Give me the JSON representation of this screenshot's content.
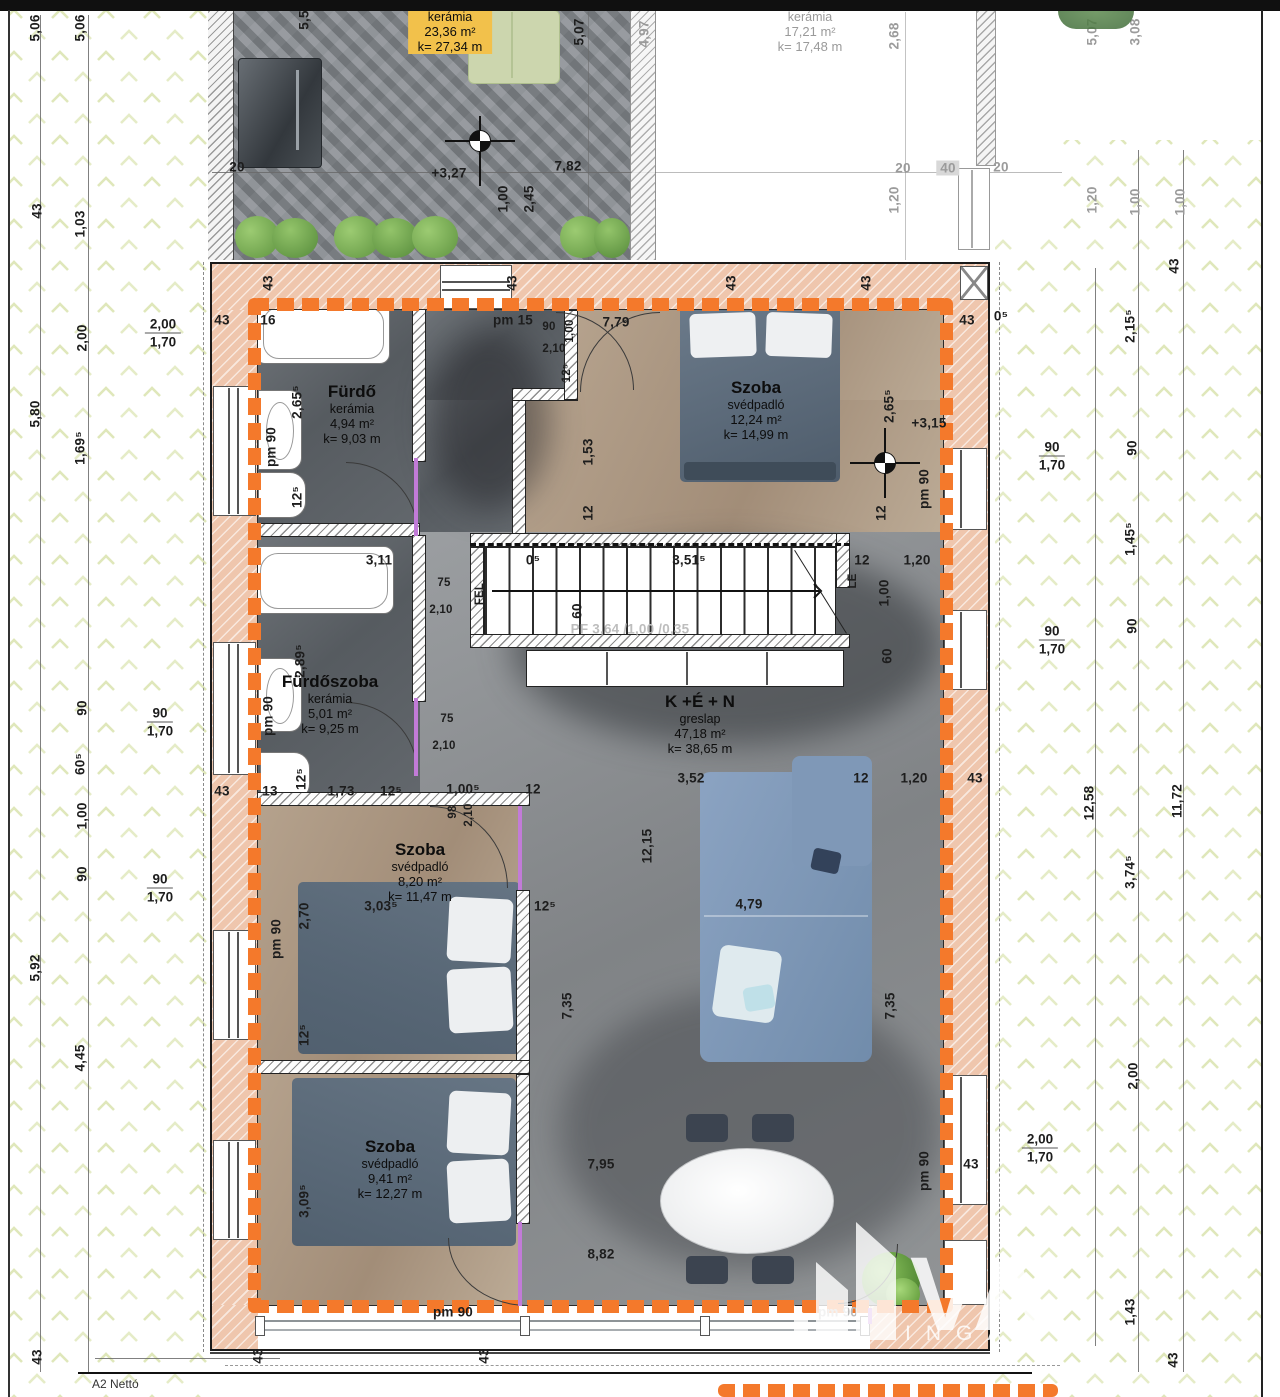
{
  "sheet": {
    "bottom_label": "A2   Nettó"
  },
  "colors": {
    "accent_orange": "#f4792b",
    "wall_pink": "#efc6ad",
    "highlight_yellow": "#f2c14b",
    "sofa_blue": "#7f99bb"
  },
  "watermark": {
    "letters": "VA",
    "sub": "INGA"
  },
  "stair": {
    "spec": "PF 3,64 /1,00 /0,35",
    "up": "FEL",
    "down": "LE"
  },
  "rooms": [
    {
      "title": "Tetőterasz",
      "mat": "kerámia",
      "area": "23,36 m²",
      "k": "k= 27,34 m",
      "x": 450,
      "y": -10,
      "cls": "hl"
    },
    {
      "title": "Tetőterasz",
      "mat": "kerámia",
      "area": "17,21 m²",
      "k": "k= 17,48 m",
      "x": 810,
      "y": -10,
      "cls": "grey"
    },
    {
      "title": "Fürdő",
      "mat": "kerámia",
      "area": "4,94 m²",
      "k": "k= 9,03 m",
      "x": 352,
      "y": 382,
      "cls": ""
    },
    {
      "title": "Szoba",
      "mat": "svédpadló",
      "area": "12,24 m²",
      "k": "k= 14,99 m",
      "x": 756,
      "y": 378,
      "cls": ""
    },
    {
      "title": "Fürdőszoba",
      "mat": "kerámia",
      "area": "5,01 m²",
      "k": "k= 9,25 m",
      "x": 330,
      "y": 672,
      "cls": ""
    },
    {
      "title": "K +É + N",
      "mat": "greslap",
      "area": "47,18 m²",
      "k": "k= 38,65 m",
      "x": 700,
      "y": 692,
      "cls": ""
    },
    {
      "title": "Szoba",
      "mat": "svédpadló",
      "area": "8,20 m²",
      "k": "k= 11,47 m",
      "x": 420,
      "y": 840,
      "cls": ""
    },
    {
      "title": "Szoba",
      "mat": "svédpadló",
      "area": "9,41 m²",
      "k": "k= 12,27 m",
      "x": 390,
      "y": 1137,
      "cls": ""
    }
  ],
  "window_tags": [
    {
      "top": "2,00",
      "bot": "1,70",
      "x": 163,
      "y": 333
    },
    {
      "top": "90",
      "bot": "1,70",
      "x": 160,
      "y": 722
    },
    {
      "top": "90",
      "bot": "1,70",
      "x": 160,
      "y": 888
    },
    {
      "top": "90",
      "bot": "1,70",
      "x": 1052,
      "y": 456
    },
    {
      "top": "90",
      "bot": "1,70",
      "x": 1052,
      "y": 640
    },
    {
      "top": "2,00",
      "bot": "1,70",
      "x": 1040,
      "y": 1148
    }
  ],
  "dimensions": [
    {
      "t": "5,06",
      "x": 35,
      "y": 28,
      "v": 1
    },
    {
      "t": "5,06",
      "x": 80,
      "y": 28,
      "v": 1
    },
    {
      "t": "5,5",
      "x": 304,
      "y": 20,
      "v": 1
    },
    {
      "t": "5,07",
      "x": 579,
      "y": 32,
      "v": 1
    },
    {
      "t": "4,97",
      "x": 644,
      "y": 34,
      "v": 1,
      "c": "g"
    },
    {
      "t": "2,68",
      "x": 894,
      "y": 36,
      "v": 1,
      "c": "g"
    },
    {
      "t": "5,07",
      "x": 1092,
      "y": 32,
      "v": 1,
      "c": "g"
    },
    {
      "t": "3,08",
      "x": 1135,
      "y": 32,
      "v": 1,
      "c": "g"
    },
    {
      "t": "20",
      "x": 237,
      "y": 167
    },
    {
      "t": "+3,27",
      "x": 449,
      "y": 173
    },
    {
      "t": "7,82",
      "x": 568,
      "y": 166
    },
    {
      "t": "1,00",
      "x": 503,
      "y": 199,
      "v": 1
    },
    {
      "t": "2,45",
      "x": 529,
      "y": 199,
      "v": 1
    },
    {
      "t": "20",
      "x": 903,
      "y": 168,
      "c": "g"
    },
    {
      "t": "40",
      "x": 948,
      "y": 168,
      "c": "g",
      "b": 1
    },
    {
      "t": "20",
      "x": 1001,
      "y": 167,
      "c": "g"
    },
    {
      "t": "1,20",
      "x": 894,
      "y": 200,
      "v": 1,
      "c": "g"
    },
    {
      "t": "1,20",
      "x": 1092,
      "y": 200,
      "v": 1,
      "c": "g"
    },
    {
      "t": "1,00",
      "x": 1135,
      "y": 202,
      "v": 1,
      "c": "g"
    },
    {
      "t": "1,00",
      "x": 1180,
      "y": 202,
      "v": 1,
      "c": "g"
    },
    {
      "t": "43",
      "x": 37,
      "y": 211,
      "v": 1
    },
    {
      "t": "1,03",
      "x": 80,
      "y": 224,
      "v": 1
    },
    {
      "t": "2,00",
      "x": 82,
      "y": 338,
      "v": 1
    },
    {
      "t": "5,80",
      "x": 35,
      "y": 414,
      "v": 1
    },
    {
      "t": "1,69⁵",
      "x": 80,
      "y": 448,
      "v": 1
    },
    {
      "t": "90",
      "x": 82,
      "y": 708,
      "v": 1
    },
    {
      "t": "60⁵",
      "x": 80,
      "y": 764,
      "v": 1
    },
    {
      "t": "1,00",
      "x": 82,
      "y": 816,
      "v": 1
    },
    {
      "t": "90",
      "x": 82,
      "y": 874,
      "v": 1
    },
    {
      "t": "5,92",
      "x": 35,
      "y": 968,
      "v": 1
    },
    {
      "t": "4,45",
      "x": 80,
      "y": 1058,
      "v": 1
    },
    {
      "t": "43",
      "x": 37,
      "y": 1357,
      "v": 1
    },
    {
      "t": "43",
      "x": 222,
      "y": 320
    },
    {
      "t": "16",
      "x": 268,
      "y": 320
    },
    {
      "t": "43",
      "x": 268,
      "y": 283,
      "v": 1
    },
    {
      "t": "43",
      "x": 512,
      "y": 283,
      "v": 1
    },
    {
      "t": "43",
      "x": 731,
      "y": 283,
      "v": 1
    },
    {
      "t": "43",
      "x": 866,
      "y": 283,
      "v": 1
    },
    {
      "t": "pm 15",
      "x": 513,
      "y": 320
    },
    {
      "t": "90",
      "x": 549,
      "y": 327,
      "c": "sm"
    },
    {
      "t": "2,10",
      "x": 554,
      "y": 349,
      "c": "sm"
    },
    {
      "t": "1,00",
      "x": 570,
      "y": 331,
      "v": 1,
      "c": "sm"
    },
    {
      "t": "12⁵",
      "x": 567,
      "y": 373,
      "v": 1,
      "c": "sm"
    },
    {
      "t": "7,79",
      "x": 616,
      "y": 322
    },
    {
      "t": "43",
      "x": 967,
      "y": 320
    },
    {
      "t": "0⁵",
      "x": 1001,
      "y": 316
    },
    {
      "t": "2,65⁵",
      "x": 297,
      "y": 402,
      "v": 1
    },
    {
      "t": "pm 90",
      "x": 271,
      "y": 447,
      "v": 1
    },
    {
      "t": "12⁵",
      "x": 297,
      "y": 497,
      "v": 1
    },
    {
      "t": "1,53",
      "x": 588,
      "y": 452,
      "v": 1
    },
    {
      "t": "12",
      "x": 588,
      "y": 513,
      "v": 1
    },
    {
      "t": "2,65⁵",
      "x": 889,
      "y": 406,
      "v": 1
    },
    {
      "t": "+3,15",
      "x": 929,
      "y": 423
    },
    {
      "t": "pm 90",
      "x": 924,
      "y": 489,
      "v": 1
    },
    {
      "t": "12",
      "x": 881,
      "y": 513,
      "v": 1
    },
    {
      "t": "2,15⁵",
      "x": 1130,
      "y": 326,
      "v": 1
    },
    {
      "t": "43",
      "x": 1174,
      "y": 266,
      "v": 1
    },
    {
      "t": "90",
      "x": 1132,
      "y": 448,
      "v": 1
    },
    {
      "t": "1,45⁵",
      "x": 1130,
      "y": 539,
      "v": 1
    },
    {
      "t": "90",
      "x": 1132,
      "y": 626,
      "v": 1
    },
    {
      "t": "3,11",
      "x": 379,
      "y": 560
    },
    {
      "t": "0⁵",
      "x": 533,
      "y": 560
    },
    {
      "t": "3,51⁵",
      "x": 689,
      "y": 560
    },
    {
      "t": "12",
      "x": 862,
      "y": 560
    },
    {
      "t": "1,20",
      "x": 917,
      "y": 560
    },
    {
      "t": "1,00",
      "x": 884,
      "y": 593,
      "v": 1
    },
    {
      "t": "60",
      "x": 577,
      "y": 611,
      "v": 1
    },
    {
      "t": "60",
      "x": 887,
      "y": 656,
      "v": 1
    },
    {
      "t": "FEL",
      "x": 480,
      "y": 594,
      "v": 1,
      "c": "sm"
    },
    {
      "t": "LE",
      "x": 853,
      "y": 581,
      "v": 1,
      "c": "sm"
    },
    {
      "t": "PF 3,64 /1,00 /0,35",
      "x": 630,
      "y": 629,
      "c": "lg"
    },
    {
      "t": "2,89⁵",
      "x": 300,
      "y": 661,
      "v": 1
    },
    {
      "t": "pm 90",
      "x": 268,
      "y": 716,
      "v": 1
    },
    {
      "t": "75",
      "x": 444,
      "y": 583,
      "c": "sm"
    },
    {
      "t": "2,10",
      "x": 441,
      "y": 610,
      "c": "sm"
    },
    {
      "t": "75",
      "x": 447,
      "y": 719,
      "c": "sm"
    },
    {
      "t": "2,10",
      "x": 444,
      "y": 746,
      "c": "sm"
    },
    {
      "t": "12⁵",
      "x": 301,
      "y": 779,
      "v": 1
    },
    {
      "t": "43",
      "x": 222,
      "y": 791
    },
    {
      "t": "13",
      "x": 270,
      "y": 791
    },
    {
      "t": "1,73",
      "x": 341,
      "y": 791
    },
    {
      "t": "12⁵",
      "x": 391,
      "y": 791
    },
    {
      "t": "1,00⁵",
      "x": 463,
      "y": 789
    },
    {
      "t": "98",
      "x": 453,
      "y": 812,
      "v": 1,
      "c": "sm"
    },
    {
      "t": "2,10",
      "x": 469,
      "y": 815,
      "v": 1,
      "c": "sm"
    },
    {
      "t": "12",
      "x": 533,
      "y": 789
    },
    {
      "t": "3,52",
      "x": 691,
      "y": 778
    },
    {
      "t": "12",
      "x": 861,
      "y": 778
    },
    {
      "t": "1,20",
      "x": 914,
      "y": 778
    },
    {
      "t": "43",
      "x": 975,
      "y": 778
    },
    {
      "t": "12,15",
      "x": 647,
      "y": 846,
      "v": 1
    },
    {
      "t": "3,03⁵",
      "x": 381,
      "y": 906
    },
    {
      "t": "12⁵",
      "x": 545,
      "y": 906
    },
    {
      "t": "2,70",
      "x": 304,
      "y": 916,
      "v": 1
    },
    {
      "t": "pm 90",
      "x": 276,
      "y": 939,
      "v": 1
    },
    {
      "t": "12⁵",
      "x": 304,
      "y": 1035,
      "v": 1
    },
    {
      "t": "4,79",
      "x": 749,
      "y": 904
    },
    {
      "t": "7,35",
      "x": 567,
      "y": 1006,
      "v": 1
    },
    {
      "t": "7,35",
      "x": 890,
      "y": 1006,
      "v": 1
    },
    {
      "t": "7,95",
      "x": 601,
      "y": 1164
    },
    {
      "t": "8,82",
      "x": 601,
      "y": 1254
    },
    {
      "t": "pm 90",
      "x": 924,
      "y": 1171,
      "v": 1
    },
    {
      "t": "43",
      "x": 971,
      "y": 1164
    },
    {
      "t": "3,09⁵",
      "x": 304,
      "y": 1201,
      "v": 1
    },
    {
      "t": "pm 90",
      "x": 453,
      "y": 1312
    },
    {
      "t": "pm 90",
      "x": 838,
      "y": 1312,
      "c": "lg"
    },
    {
      "t": "43",
      "x": 258,
      "y": 1356,
      "v": 1
    },
    {
      "t": "43",
      "x": 484,
      "y": 1356,
      "v": 1
    },
    {
      "t": "12,58",
      "x": 1089,
      "y": 803,
      "v": 1
    },
    {
      "t": "3,74⁵",
      "x": 1130,
      "y": 872,
      "v": 1
    },
    {
      "t": "11,72",
      "x": 1177,
      "y": 801,
      "v": 1
    },
    {
      "t": "2,00",
      "x": 1133,
      "y": 1076,
      "v": 1
    },
    {
      "t": "1,43",
      "x": 1130,
      "y": 1312,
      "v": 1
    },
    {
      "t": "43",
      "x": 1173,
      "y": 1360,
      "v": 1
    }
  ]
}
